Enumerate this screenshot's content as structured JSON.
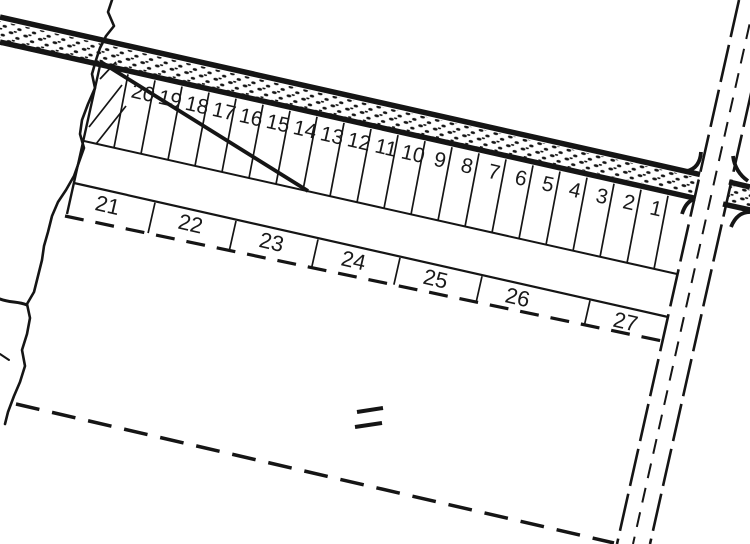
{
  "map": {
    "kind": "cadastral-plat-survey",
    "lots": {
      "strip_numbers": [
        "20",
        "19",
        "18",
        "17",
        "16",
        "15",
        "14",
        "13",
        "12",
        "11",
        "10",
        "9",
        "8",
        "7",
        "6",
        "5",
        "4",
        "3",
        "2",
        "1"
      ],
      "row_numbers": [
        "21",
        "22",
        "23",
        "24",
        "25",
        "26",
        "27"
      ]
    },
    "symbols": {
      "equals_mark": "double-dash-mark",
      "creek": "wavy-watercourse-line",
      "road_surface": "stipple-dot-band"
    },
    "colors": {
      "ink": "#151515",
      "paper": "#ffffff"
    }
  }
}
